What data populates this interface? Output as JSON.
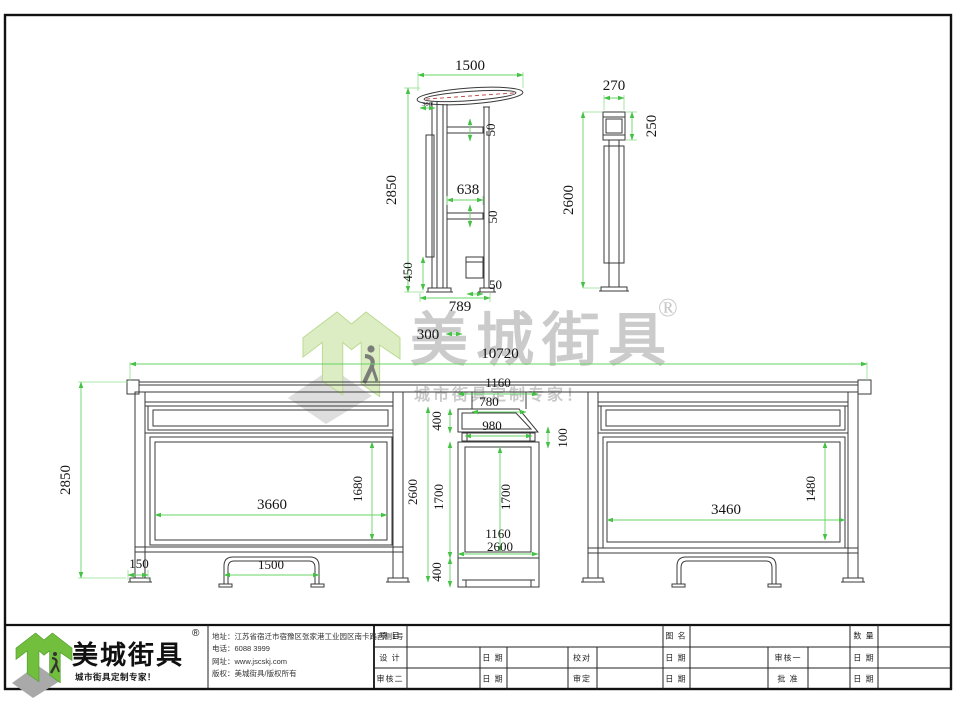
{
  "watermark": {
    "brand": "美城街具",
    "registered": "®",
    "tagline": "城市街具定制专家！"
  },
  "side_view": {
    "top_width": "1500",
    "height": "2850",
    "roof_offset": "300",
    "bar_gap_1": "50",
    "mid_width": "638",
    "bar_gap_2": "50",
    "lower_height": "450",
    "bin_width": "50",
    "base_width": "789",
    "gap_note": "300"
  },
  "post_view": {
    "width": "270",
    "head_height": "250",
    "height": "2600"
  },
  "front_view": {
    "total_width": "10720",
    "kiosk_top_width": "1160",
    "connector_width": "780",
    "header_width": "980",
    "header_height": "400",
    "neck_height": "100",
    "total_height": "2850",
    "kiosk_height": "2600",
    "kiosk_body_height": "1700",
    "panel_inner_height": "1700",
    "panel_inner_width": "1160",
    "kiosk_total": "2600",
    "base_height": "400",
    "left_panel_width": "3660",
    "left_panel_height": "1680",
    "post_width": "150",
    "bench_width": "1500",
    "right_panel_width": "3460",
    "right_panel_height": "1480"
  },
  "title_block": {
    "logo": {
      "brand": "美城街具",
      "registered": "®",
      "tagline": "城市街具定制专家！"
    },
    "company": {
      "address": "地址：江苏省宿迁市宿豫区张家港工业园区南卡路西侧1号",
      "phone": "电话：6088 3999",
      "website": "网址：www.jscskj.com",
      "copyright": "版权：美城街具/版权所有"
    },
    "table": {
      "r1c1": "项 目",
      "r1c2": "图 名",
      "r1c3": "数 量",
      "r2c1": "设 计",
      "r2c2": "日 期",
      "r2c3": "校对",
      "r2c4": "日 期",
      "r2c5": "审核一",
      "r2c6": "日 期",
      "r3c1": "审核二",
      "r3c2": "日 期",
      "r3c3": "审定",
      "r3c4": "日 期",
      "r3c5": "批 准",
      "r3c6": "日 期"
    }
  }
}
